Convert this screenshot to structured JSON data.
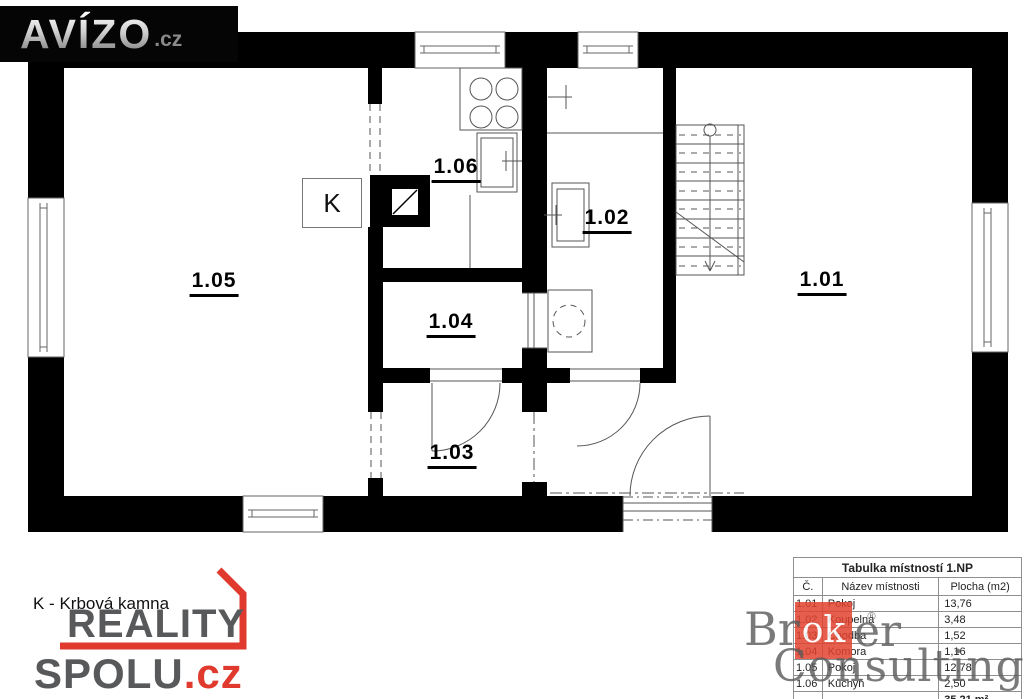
{
  "logos": {
    "avizo": {
      "name": "AVÍZO",
      "tld": ".cz"
    },
    "reality_spolu": {
      "line1": "REALITY",
      "line2": "SPOLU",
      "tld": ".cz"
    },
    "broker": {
      "part1": "Br",
      "boxed": "ok",
      "part2": "er",
      "line2": "Consulting",
      "registered": "®"
    }
  },
  "legend": {
    "fireplace": "K - Krbová kamna"
  },
  "plan": {
    "fireplace_label": "K",
    "rooms": [
      {
        "label": "1.05"
      },
      {
        "label": "1.06"
      },
      {
        "label": "1.02"
      },
      {
        "label": "1.04"
      },
      {
        "label": "1.03"
      },
      {
        "label": "1.01"
      }
    ]
  },
  "room_table": {
    "title": "Tabulka místností 1.NP",
    "columns": [
      "Č.",
      "Název místnosti",
      "Plocha (m2)"
    ],
    "rows": [
      {
        "no": "1.01",
        "name": "Pokoj",
        "area": "13,76"
      },
      {
        "no": "1.02",
        "name": "Koupelna",
        "area": "3,48"
      },
      {
        "no": "1.03",
        "name": "Chodba",
        "area": "1,52"
      },
      {
        "no": "1.04",
        "name": "Komora",
        "area": "1,16"
      },
      {
        "no": "1.05",
        "name": "Pokoj",
        "area": "12,78"
      },
      {
        "no": "1.06",
        "name": "Kuchyň",
        "area": "2,50"
      }
    ],
    "total": "35,21 m²"
  },
  "colors": {
    "wall": "#000000",
    "thin_line": "#555555",
    "accent_red": "#e0392e",
    "logo_gray": "#58595b",
    "table_border": "#8f8f8f",
    "broker_red": "#e2432e"
  }
}
